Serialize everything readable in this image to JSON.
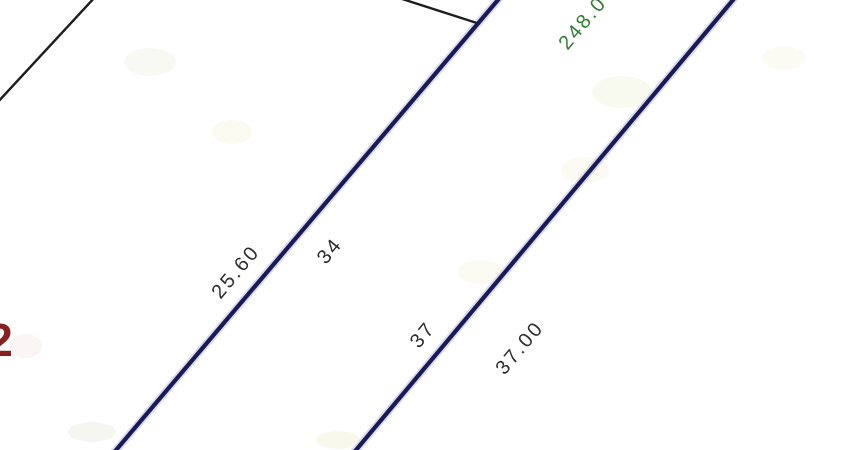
{
  "drawing": {
    "background": "#ffffff"
  },
  "colors": {
    "parcel_boundary": "#1a1a58",
    "parcel_boundary_halo": "#a9acce",
    "adjacent_boundary": "#1e1e1e",
    "dimension_text": "#2d2d2d",
    "distance_text_green": "#2f7d31",
    "parcel_number_red": "#8a1f1f"
  },
  "labels": {
    "dim_left": "25.60",
    "lot_left": "34",
    "lot_right": "37",
    "dim_right": "37.00",
    "distance_top": "248.0",
    "parcel_partial": "2"
  }
}
